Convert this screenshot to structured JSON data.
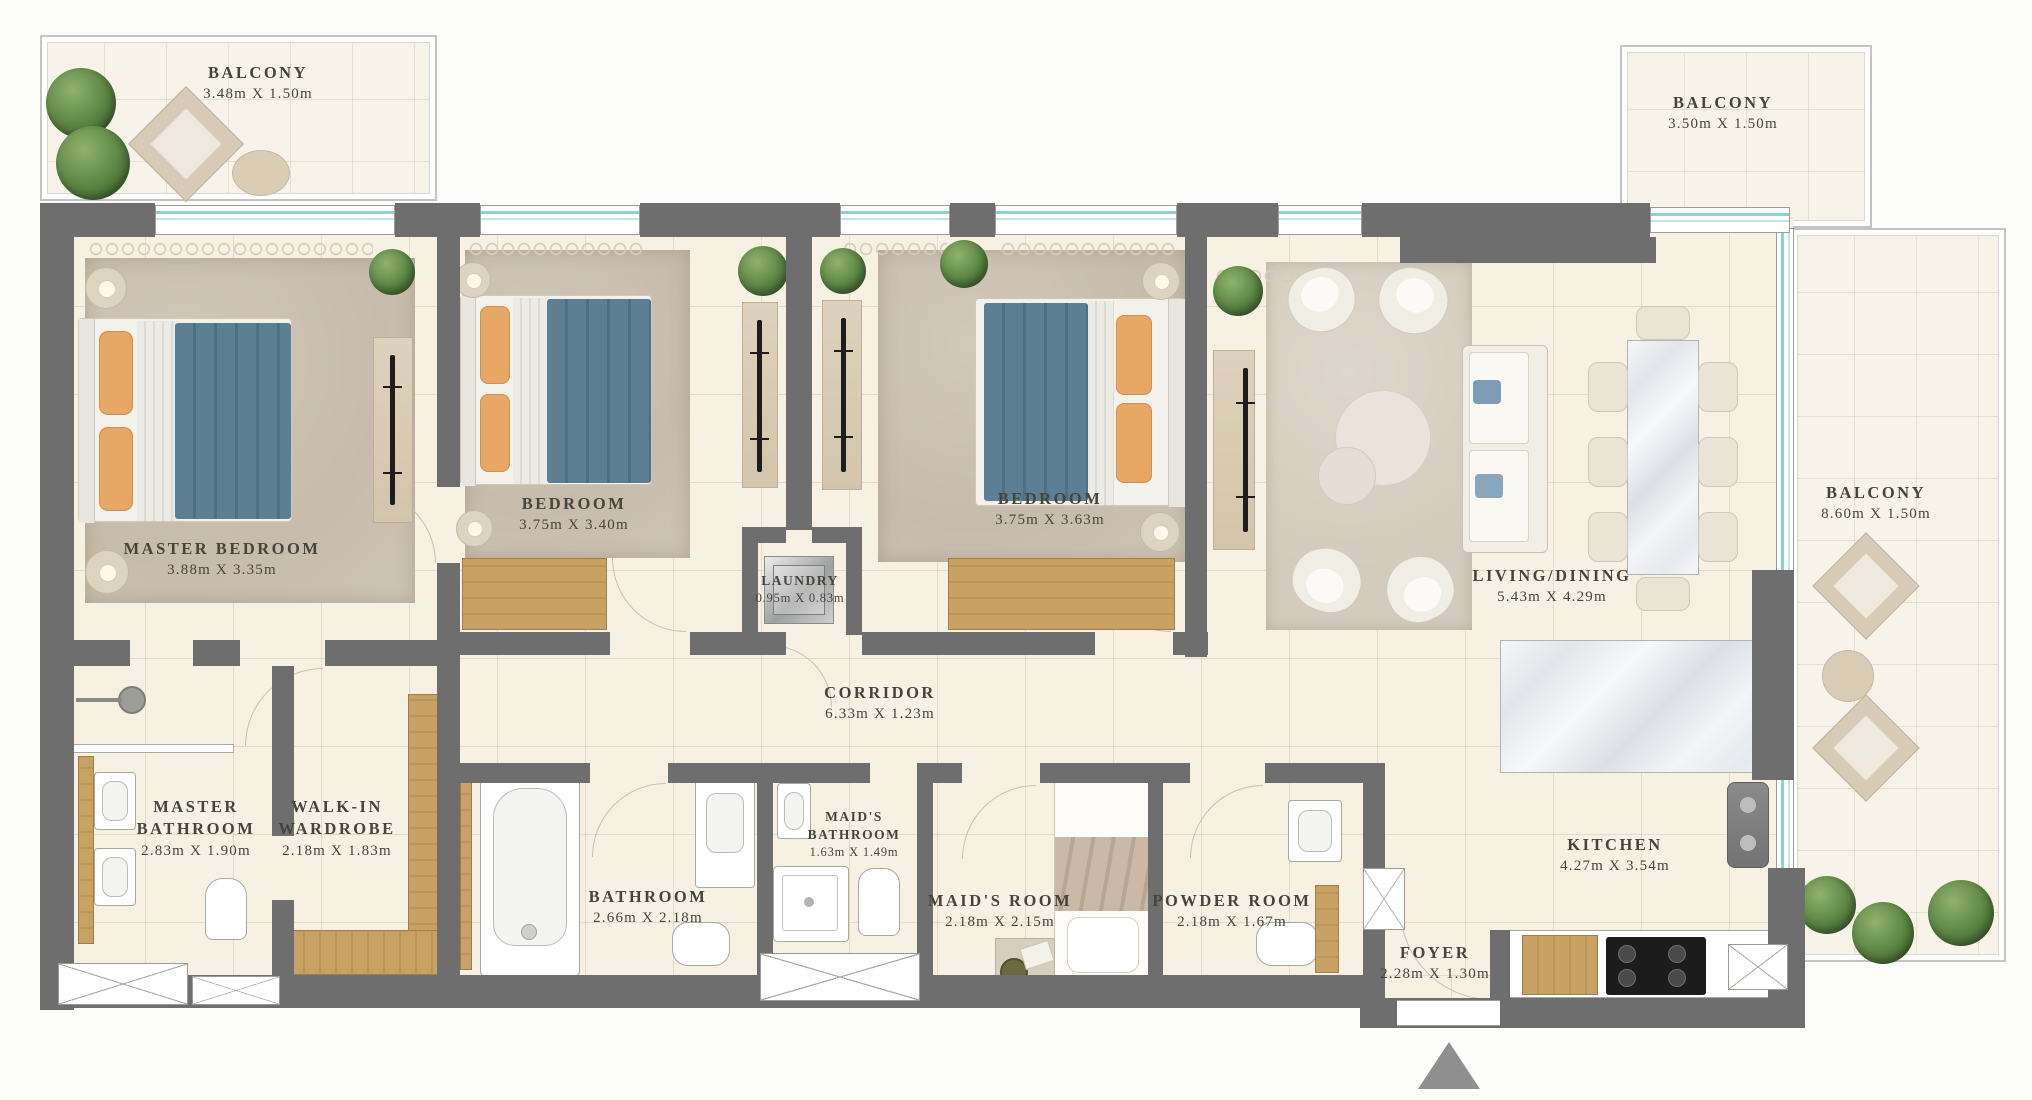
{
  "plan_title": "3 Bedroom Apartment Floor Plan",
  "rooms": {
    "balcony_tl": {
      "name": "BALCONY",
      "dims": "3.48m X 1.50m"
    },
    "balcony_tr": {
      "name": "BALCONY",
      "dims": "3.50m X 1.50m"
    },
    "balcony_r": {
      "name": "BALCONY",
      "dims": "8.60m X 1.50m"
    },
    "master_bedroom": {
      "name": "MASTER BEDROOM",
      "dims": "3.88m X 3.35m"
    },
    "bedroom_1": {
      "name": "BEDROOM",
      "dims": "3.75m X 3.40m"
    },
    "bedroom_2": {
      "name": "BEDROOM",
      "dims": "3.75m X 3.63m"
    },
    "laundry": {
      "name": "LAUNDRY",
      "dims": "0.95m X 0.83m"
    },
    "living_dining": {
      "name": "LIVING/DINING",
      "dims": "5.43m X 4.29m"
    },
    "corridor": {
      "name": "CORRIDOR",
      "dims": "6.33m X 1.23m"
    },
    "master_bathroom": {
      "name": "MASTER BATHROOM",
      "dims": "2.83m X 1.90m"
    },
    "walk_in_wardrobe": {
      "name": "WALK-IN WARDROBE",
      "dims": "2.18m X 1.83m"
    },
    "bathroom": {
      "name": "BATHROOM",
      "dims": "2.66m X 2.18m"
    },
    "maids_bathroom": {
      "name": "MAID'S BATHROOM",
      "dims": "1.63m X 1.49m"
    },
    "maids_room": {
      "name": "MAID'S ROOM",
      "dims": "2.18m X 2.15m"
    },
    "powder_room": {
      "name": "POWDER ROOM",
      "dims": "2.18m X 1.67m"
    },
    "foyer": {
      "name": "FOYER",
      "dims": "2.28m X 1.30m"
    },
    "kitchen": {
      "name": "KITCHEN",
      "dims": "4.27m X 3.54m"
    }
  },
  "colors": {
    "wall": "#6e6e6e",
    "wall_light": "#c4c4c4",
    "floor": "#f6f1e3",
    "floor_outdoor": "#f7f3e8",
    "window_teal": "#8fd2d2",
    "wood": "#c8a265",
    "blanket": "#5c7f93",
    "pillow": "#e7a765",
    "plant": "#567f3e",
    "label": "#45453d",
    "triangle": "#8f8f8f"
  }
}
